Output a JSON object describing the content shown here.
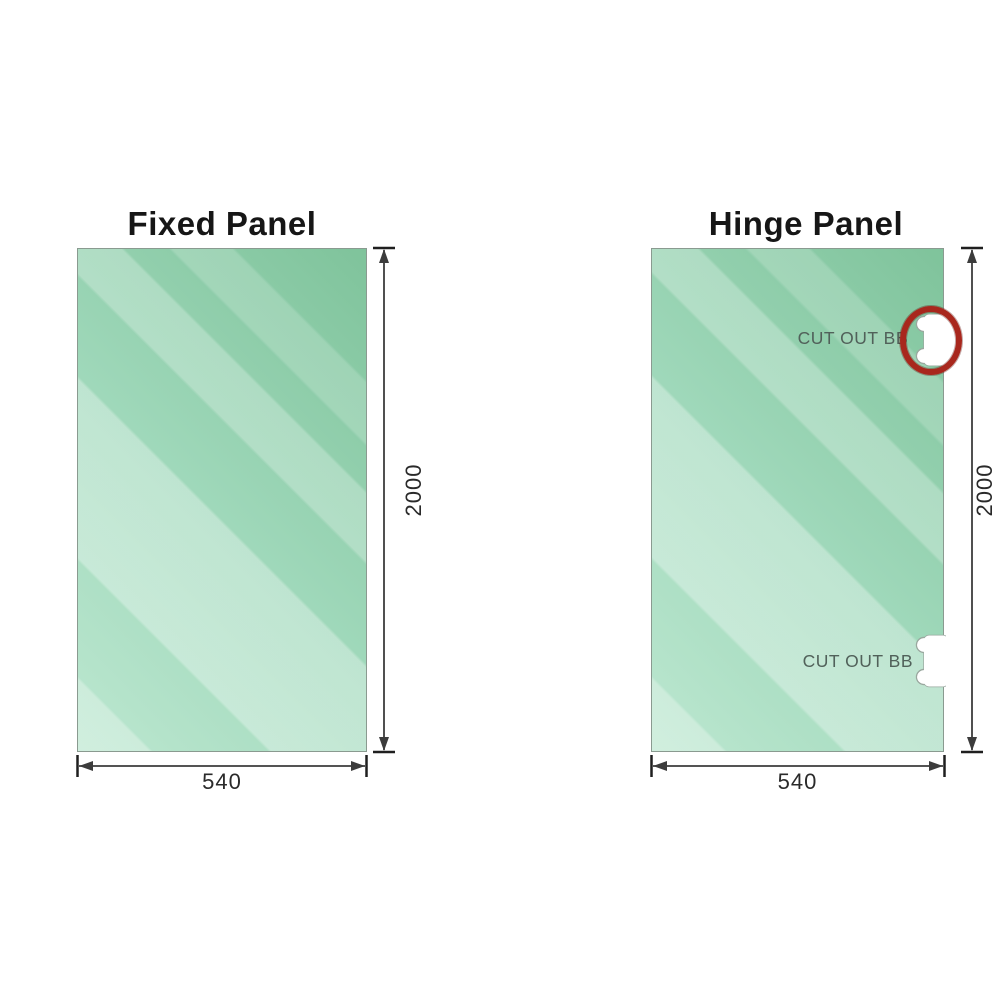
{
  "diagram": {
    "panels": [
      {
        "title": "Fixed Panel",
        "width_mm": "540",
        "height_mm": "2000",
        "cutouts": []
      },
      {
        "title": "Hinge Panel",
        "width_mm": "540",
        "height_mm": "2000",
        "cutouts": [
          {
            "label": "CUT OUT BB",
            "position": "top-right",
            "highlighted": true
          },
          {
            "label": "CUT OUT BB",
            "position": "bottom-right",
            "highlighted": false
          }
        ]
      }
    ],
    "colors": {
      "glass_dark": "#7fc39b",
      "glass_mid": "#9fd8ba",
      "glass_light": "#bce7d0",
      "glass_border": "#8a9a90",
      "dimension": "#3c3c3c",
      "dimension_text": "#2a2a2a",
      "title_text": "#161616",
      "cutout_label": "#51615a",
      "cutout_outline": "#9aa89f",
      "highlight_ring": "#a8271d",
      "background": "#ffffff"
    }
  }
}
